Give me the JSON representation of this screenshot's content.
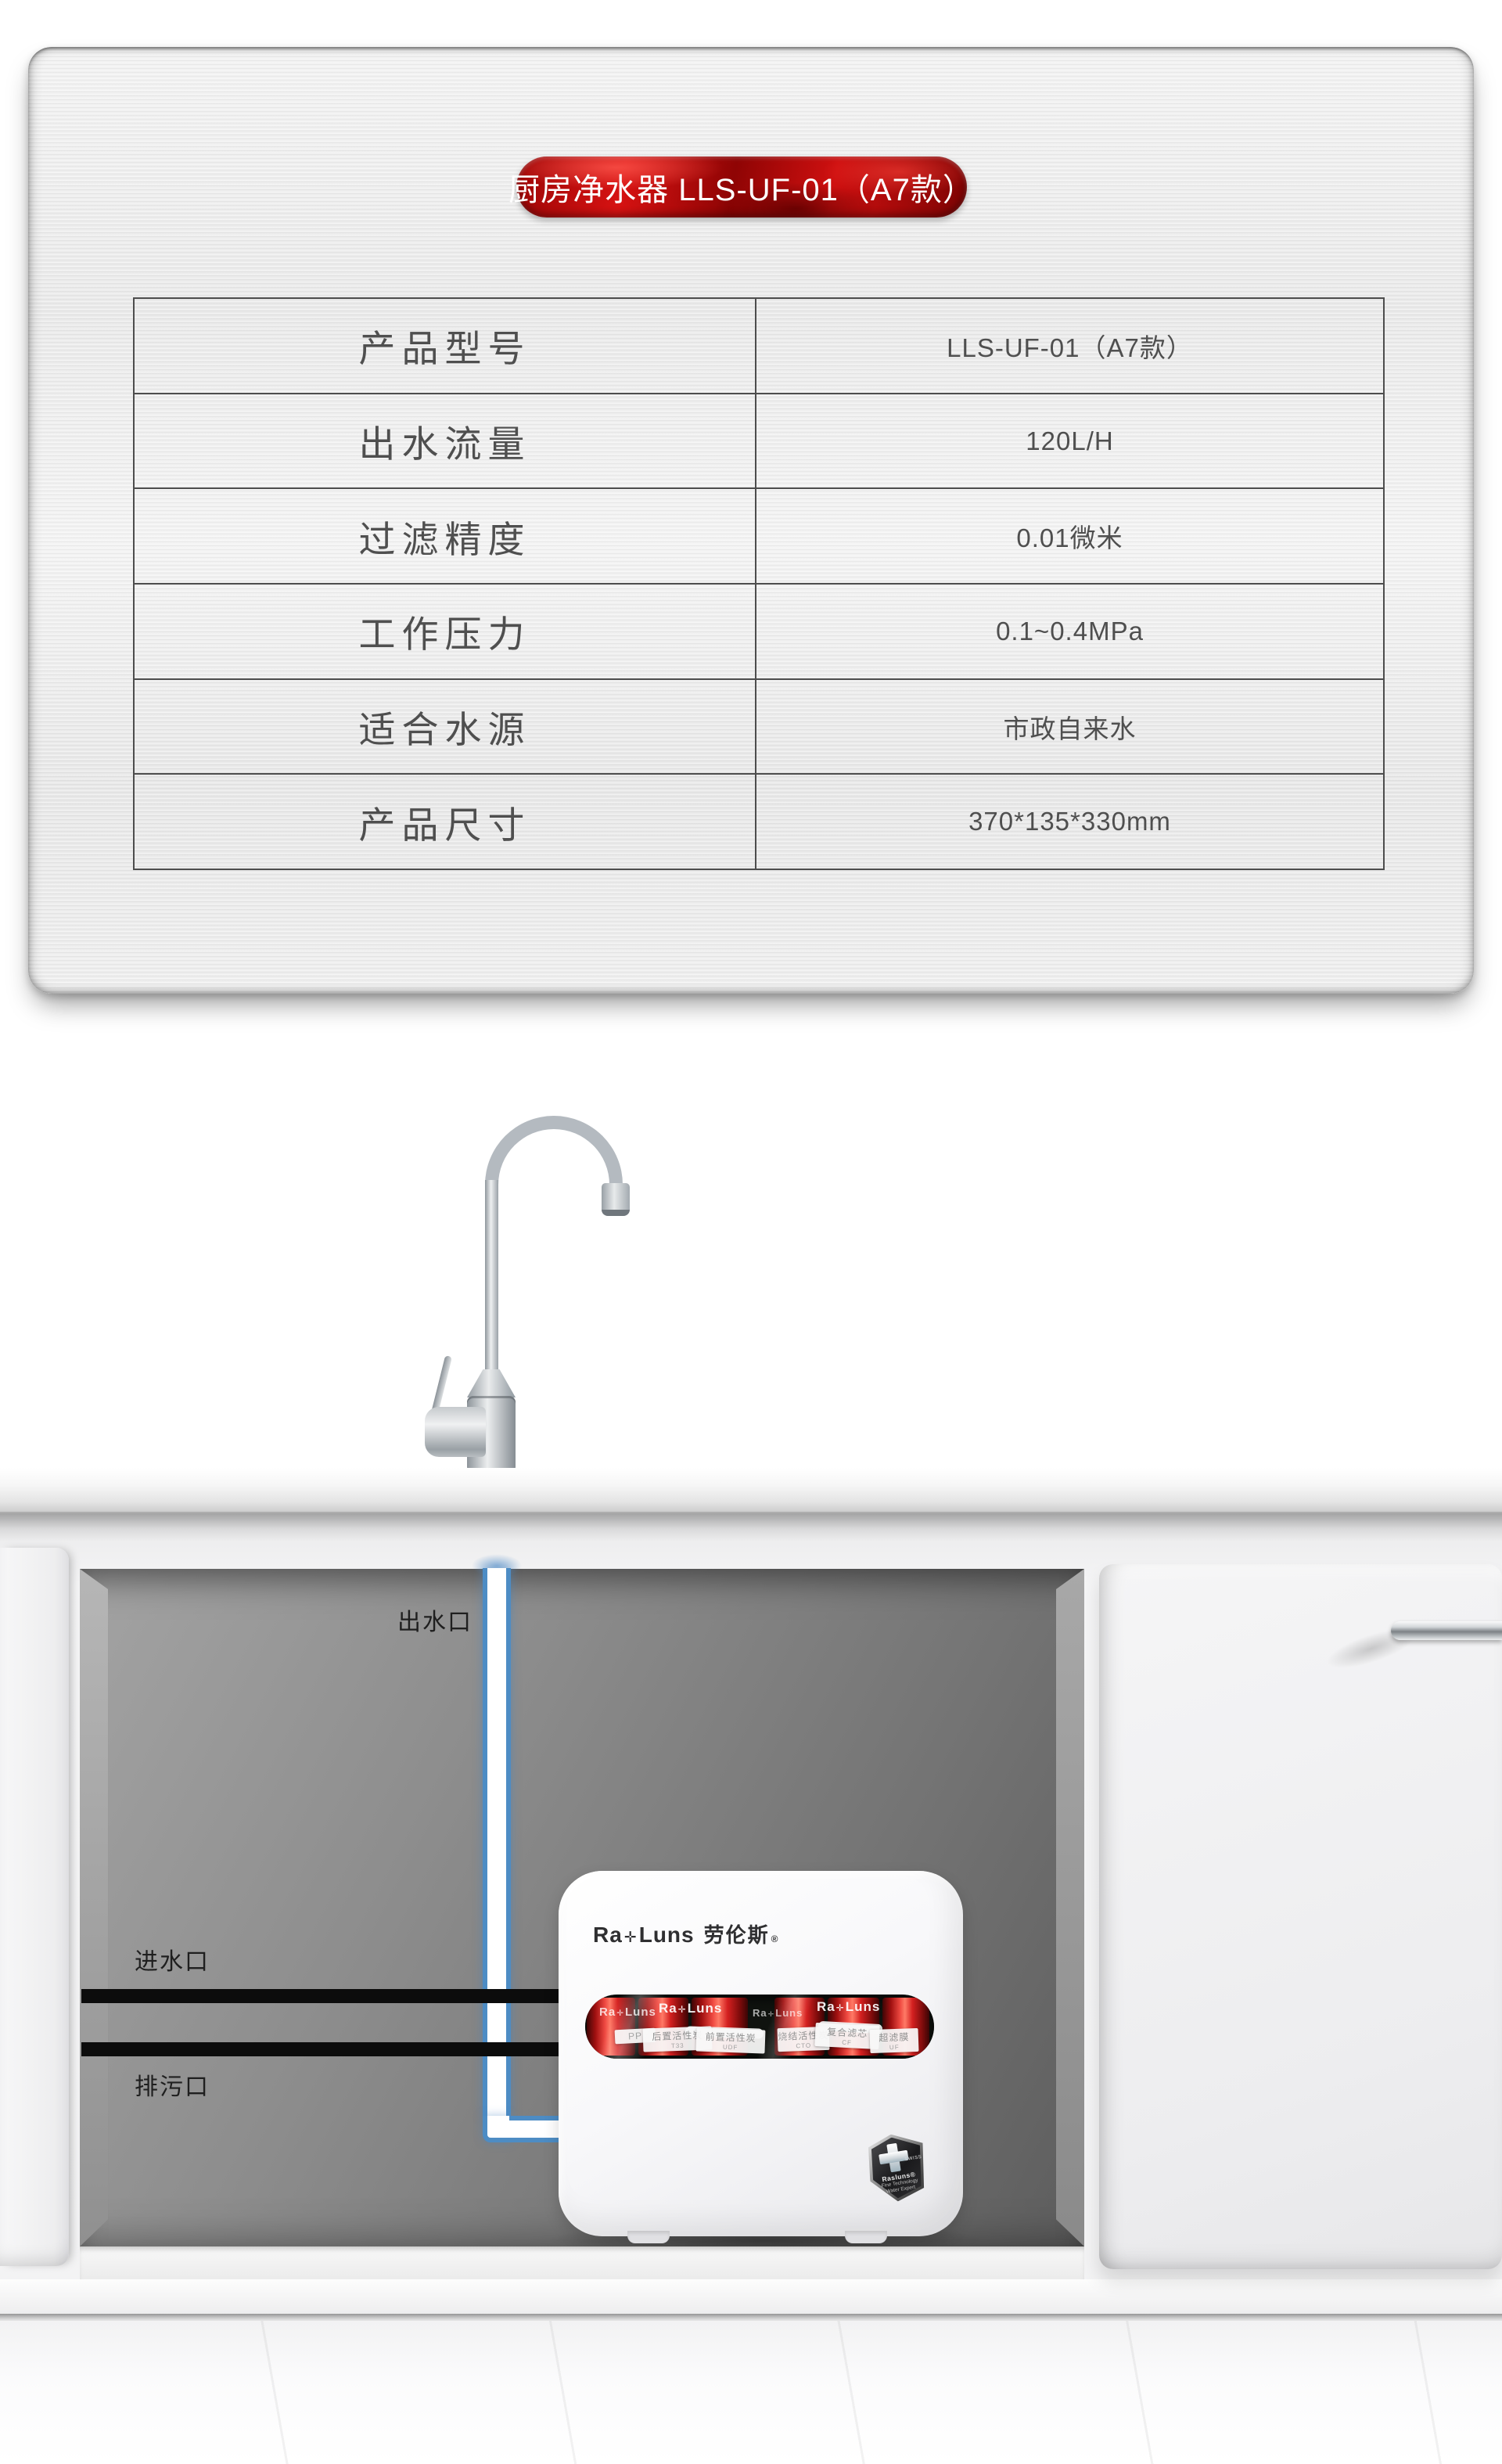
{
  "spec_panel": {
    "badge_title": "厨房净水器 LLS-UF-01（A7款）",
    "badge_color": "#b50b0b",
    "table": {
      "rows": [
        {
          "label": "产品型号",
          "value": "LLS-UF-01（A7款）"
        },
        {
          "label": "出水流量",
          "value": "120L/H"
        },
        {
          "label": "过滤精度",
          "value": "0.01微米"
        },
        {
          "label": "工作压力",
          "value": "0.1~0.4MPa"
        },
        {
          "label": "适合水源",
          "value": "市政自来水"
        },
        {
          "label": "产品尺寸",
          "value": "370*135*330mm"
        }
      ]
    }
  },
  "installation": {
    "labels": {
      "outlet": "出水口",
      "inlet": "进水口",
      "drain": "排污口"
    },
    "pipe_colors": {
      "outlet_blue": "#4d8cc4",
      "inlet_black": "#0c0c0c"
    },
    "purifier": {
      "logo": {
        "prefix": "Ra",
        "mark": "✛",
        "suffix": "Luns",
        "cn": "劳伦斯",
        "reg": "®"
      },
      "filters": [
        {
          "name": "PP",
          "code": ""
        },
        {
          "name": "后置活性炭",
          "code": "T33"
        },
        {
          "name": "前置活性炭",
          "code": "UDF"
        },
        {
          "name": "烧结活性炭",
          "code": "CTO"
        },
        {
          "name": "复合滤芯",
          "code": "CF"
        },
        {
          "name": "超滤膜",
          "code": "UF"
        }
      ],
      "badge": {
        "swiss": "SWISS",
        "brand": "Rasluns®",
        "line2": "Fine Technology",
        "line3": "Water Expert"
      }
    }
  }
}
